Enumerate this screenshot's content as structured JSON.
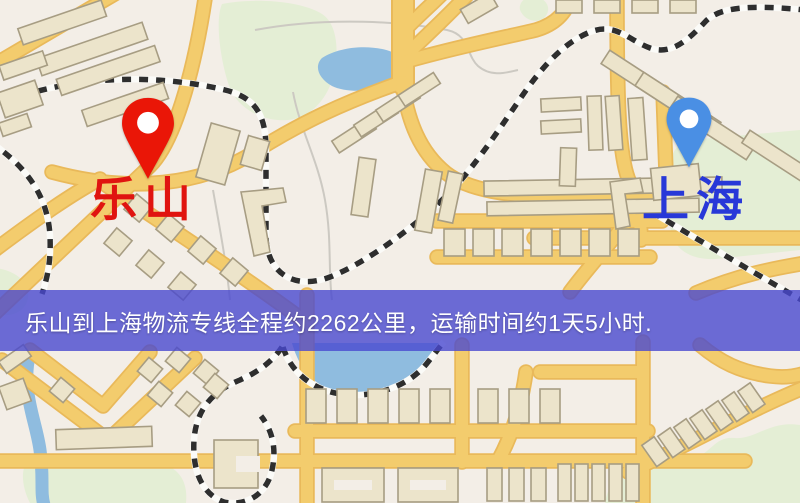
{
  "map": {
    "kind": "logistics-route-map",
    "palette": {
      "background": "#f3eee7",
      "road": "#f3cc6d",
      "road_casing": "#e9b95a",
      "building": "#ece4cb",
      "building_stroke": "#a79d83",
      "green": "#e4eed5",
      "water": "#8fbcdf",
      "railway_dark": "#2e2e2e",
      "railway_light": "#fbfbf8",
      "contour": "#ccc9c2",
      "label_red": "#e01410",
      "label_blue": "#2838d8"
    },
    "markers": [
      {
        "id": "leshan",
        "label": "乐山",
        "pin_color": "#ea1607",
        "label_color": "#e01410"
      },
      {
        "id": "shanghai",
        "label": "上海",
        "pin_color": "#4a8fe4",
        "label_color": "#2838d8"
      }
    ]
  },
  "banner": {
    "text": "乐山到上海物流专线全程约2262公里，运输时间约1天5小时.",
    "background": "rgba(72,72,208,0.80)",
    "text_color": "#ffffff"
  }
}
